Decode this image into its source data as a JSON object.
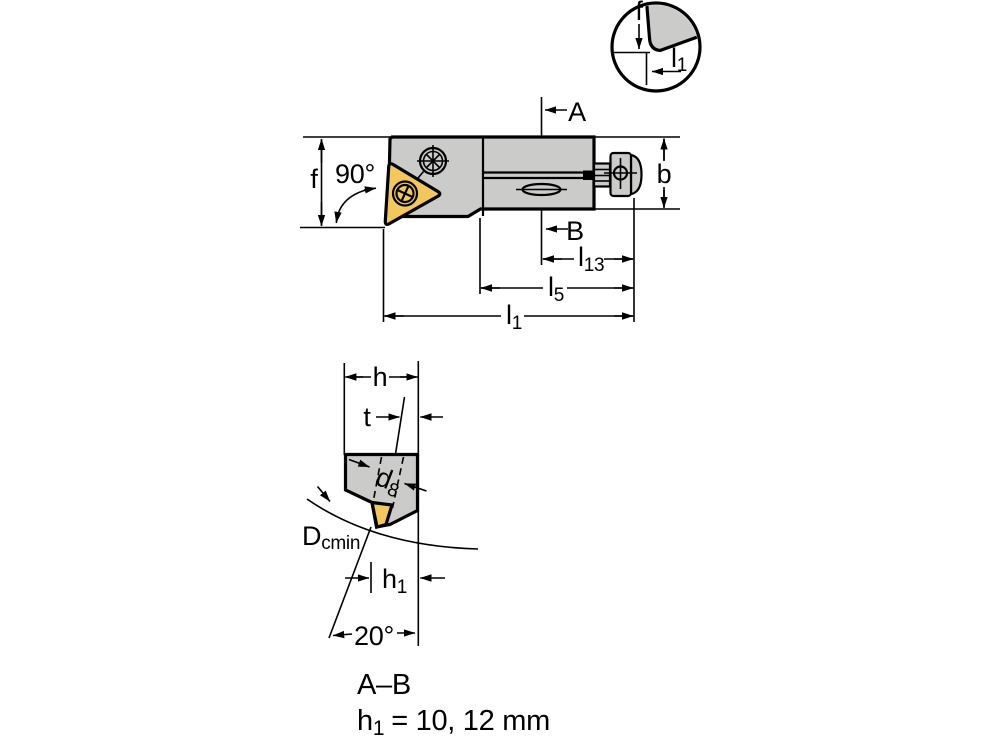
{
  "colors": {
    "background": "#ffffff",
    "body_gray": "#cbcbca",
    "insert_gold": "#f2c75e",
    "line": "#000000"
  },
  "detail_view": {
    "f_label": "f",
    "l1_base": "l",
    "l1_sub": "1"
  },
  "main_view": {
    "f_label": "f",
    "angle_label": "90°",
    "section_start_label": "A",
    "section_end_label": "B",
    "b_label": "b",
    "l13_base": "l",
    "l13_sub": "13",
    "l5_base": "l",
    "l5_sub": "5",
    "l1_base": "l",
    "l1_sub": "1"
  },
  "section_view": {
    "h_label": "h",
    "t_label": "t",
    "d8_base": "d",
    "d8_sub": "8",
    "dcmin_base": "D",
    "dcmin_sub": "cmin",
    "h1_base": "h",
    "h1_sub": "1",
    "angle_label": "20°",
    "title": "A–B",
    "note_base": "h",
    "note_sub": "1",
    "note_rest": "= 10, 12 mm"
  }
}
